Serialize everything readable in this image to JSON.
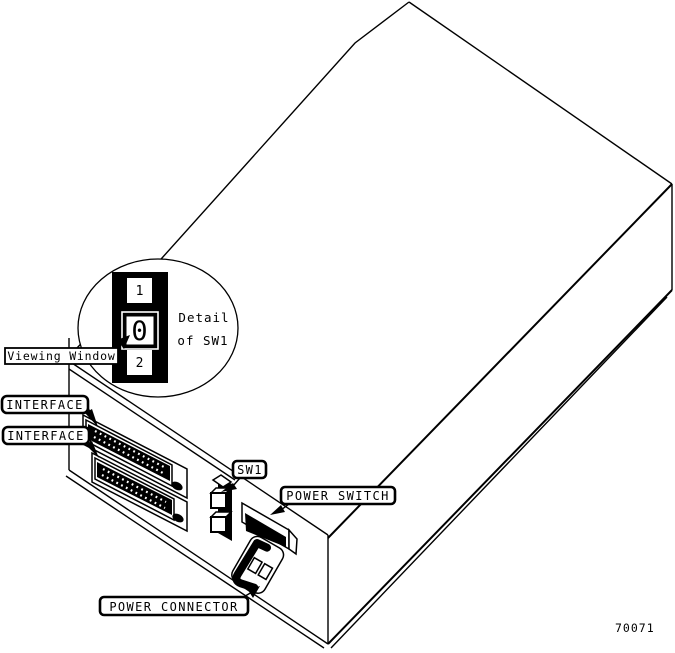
{
  "figure": {
    "figure_number": "70071",
    "background_color": "#ffffff",
    "line_color": "#000000",
    "detail_callout": {
      "title_line1": "Detail",
      "title_line2": "of SW1",
      "switch_positions": {
        "top": "1",
        "middle": "0",
        "bottom": "2"
      }
    },
    "labels": {
      "viewing_window": "Viewing Window",
      "interface_top": "INTERFACE",
      "interface_bottom": "INTERFACE",
      "sw1": "SW1",
      "power_switch": "POWER SWITCH",
      "power_connector": "POWER CONNECTOR"
    }
  }
}
